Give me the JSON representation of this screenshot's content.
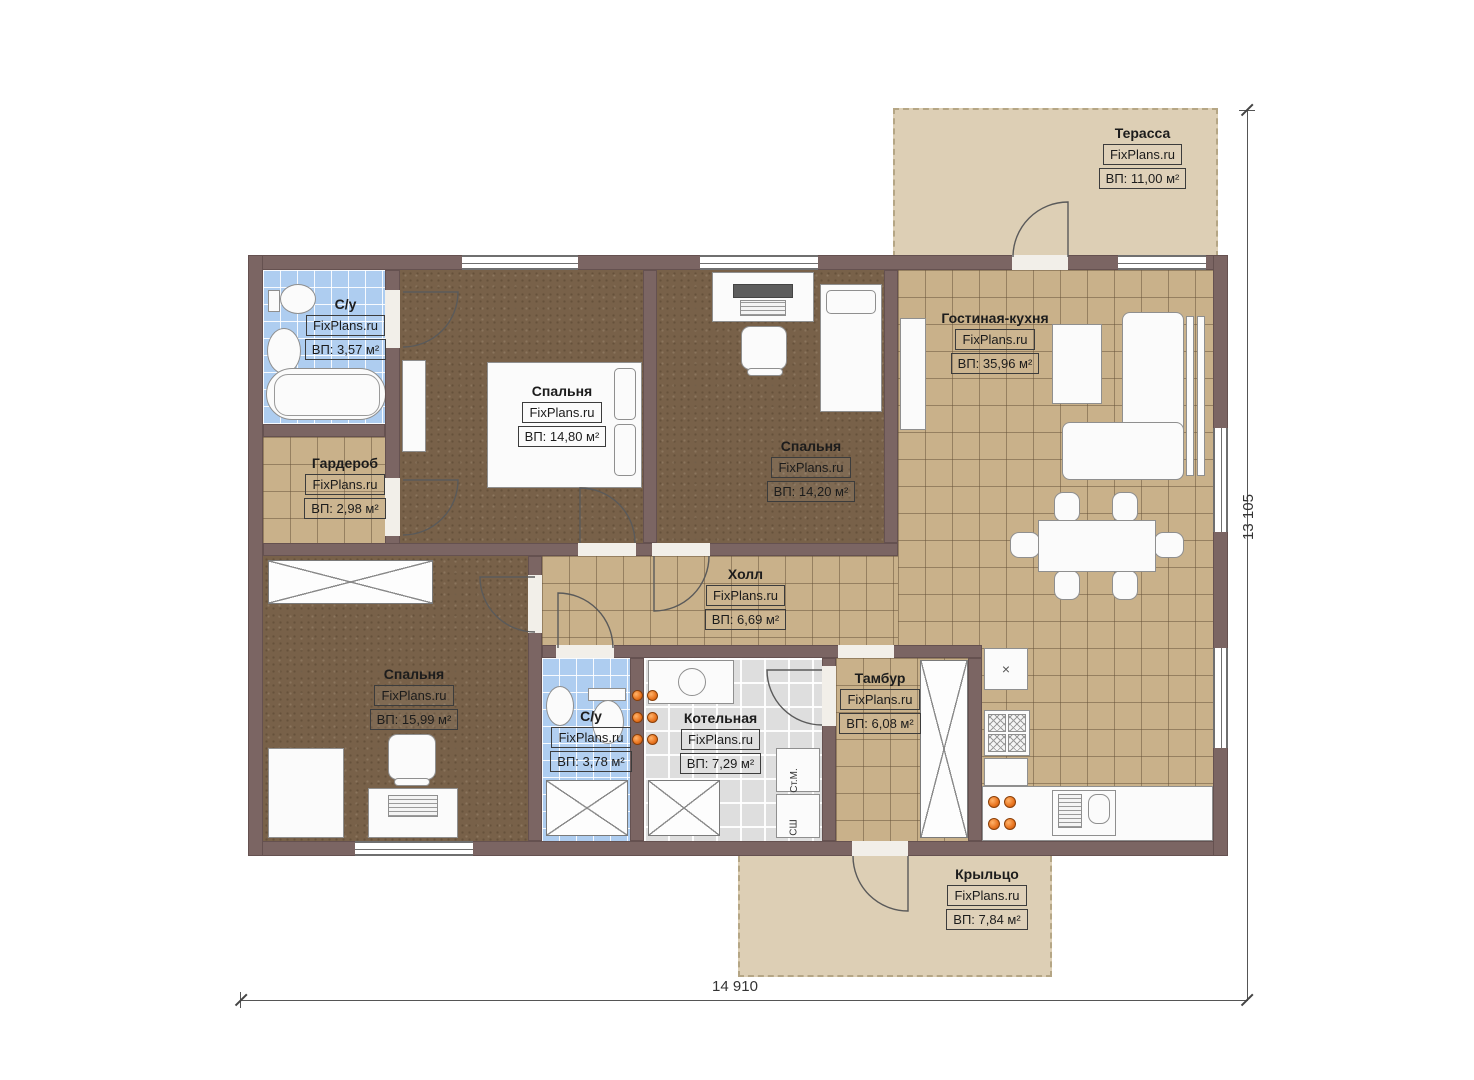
{
  "plan": {
    "watermark": "FixPlans.ru",
    "rooms": {
      "terrace": {
        "name": "Терасса",
        "area": "ВП: 11,00 м²"
      },
      "bath1": {
        "name": "С/у",
        "area": "ВП: 3,57 м²"
      },
      "bedroom1": {
        "name": "Спальня",
        "area": "ВП: 14,80 м²"
      },
      "bedroom2": {
        "name": "Спальня",
        "area": "ВП: 14,20 м²"
      },
      "living": {
        "name": "Гостиная-кухня",
        "area": "ВП: 35,96 м²"
      },
      "wardrobe": {
        "name": "Гардероб",
        "area": "ВП: 2,98 м²"
      },
      "hall": {
        "name": "Холл",
        "area": "ВП: 6,69 м²"
      },
      "bedroom3": {
        "name": "Спальня",
        "area": "ВП: 15,99 м²"
      },
      "bath2": {
        "name": "С/у",
        "area": "ВП: 3,78 м²"
      },
      "boiler": {
        "name": "Котельная",
        "area": "ВП: 7,29 м²"
      },
      "vestibule": {
        "name": "Тамбур",
        "area": "ВП: 6,08 м²"
      },
      "porch": {
        "name": "Крыльцо",
        "area": "ВП: 7,84 м²"
      }
    },
    "dimensions": {
      "width_label": "14 910",
      "height_label": "13 105"
    },
    "appliances": {
      "washer": "Ст.М.",
      "dryer": "СШ"
    },
    "symbols": {
      "fridge_cross": "×"
    },
    "colors": {
      "wall": "#7b6563",
      "floor_tile": "#c9b18a",
      "floor_carpet": "#786149",
      "floor_bath": "#aecdf0",
      "floor_boiler": "#dedede",
      "outdoor": "#ddcfb5",
      "burner": "#e8731e"
    }
  }
}
